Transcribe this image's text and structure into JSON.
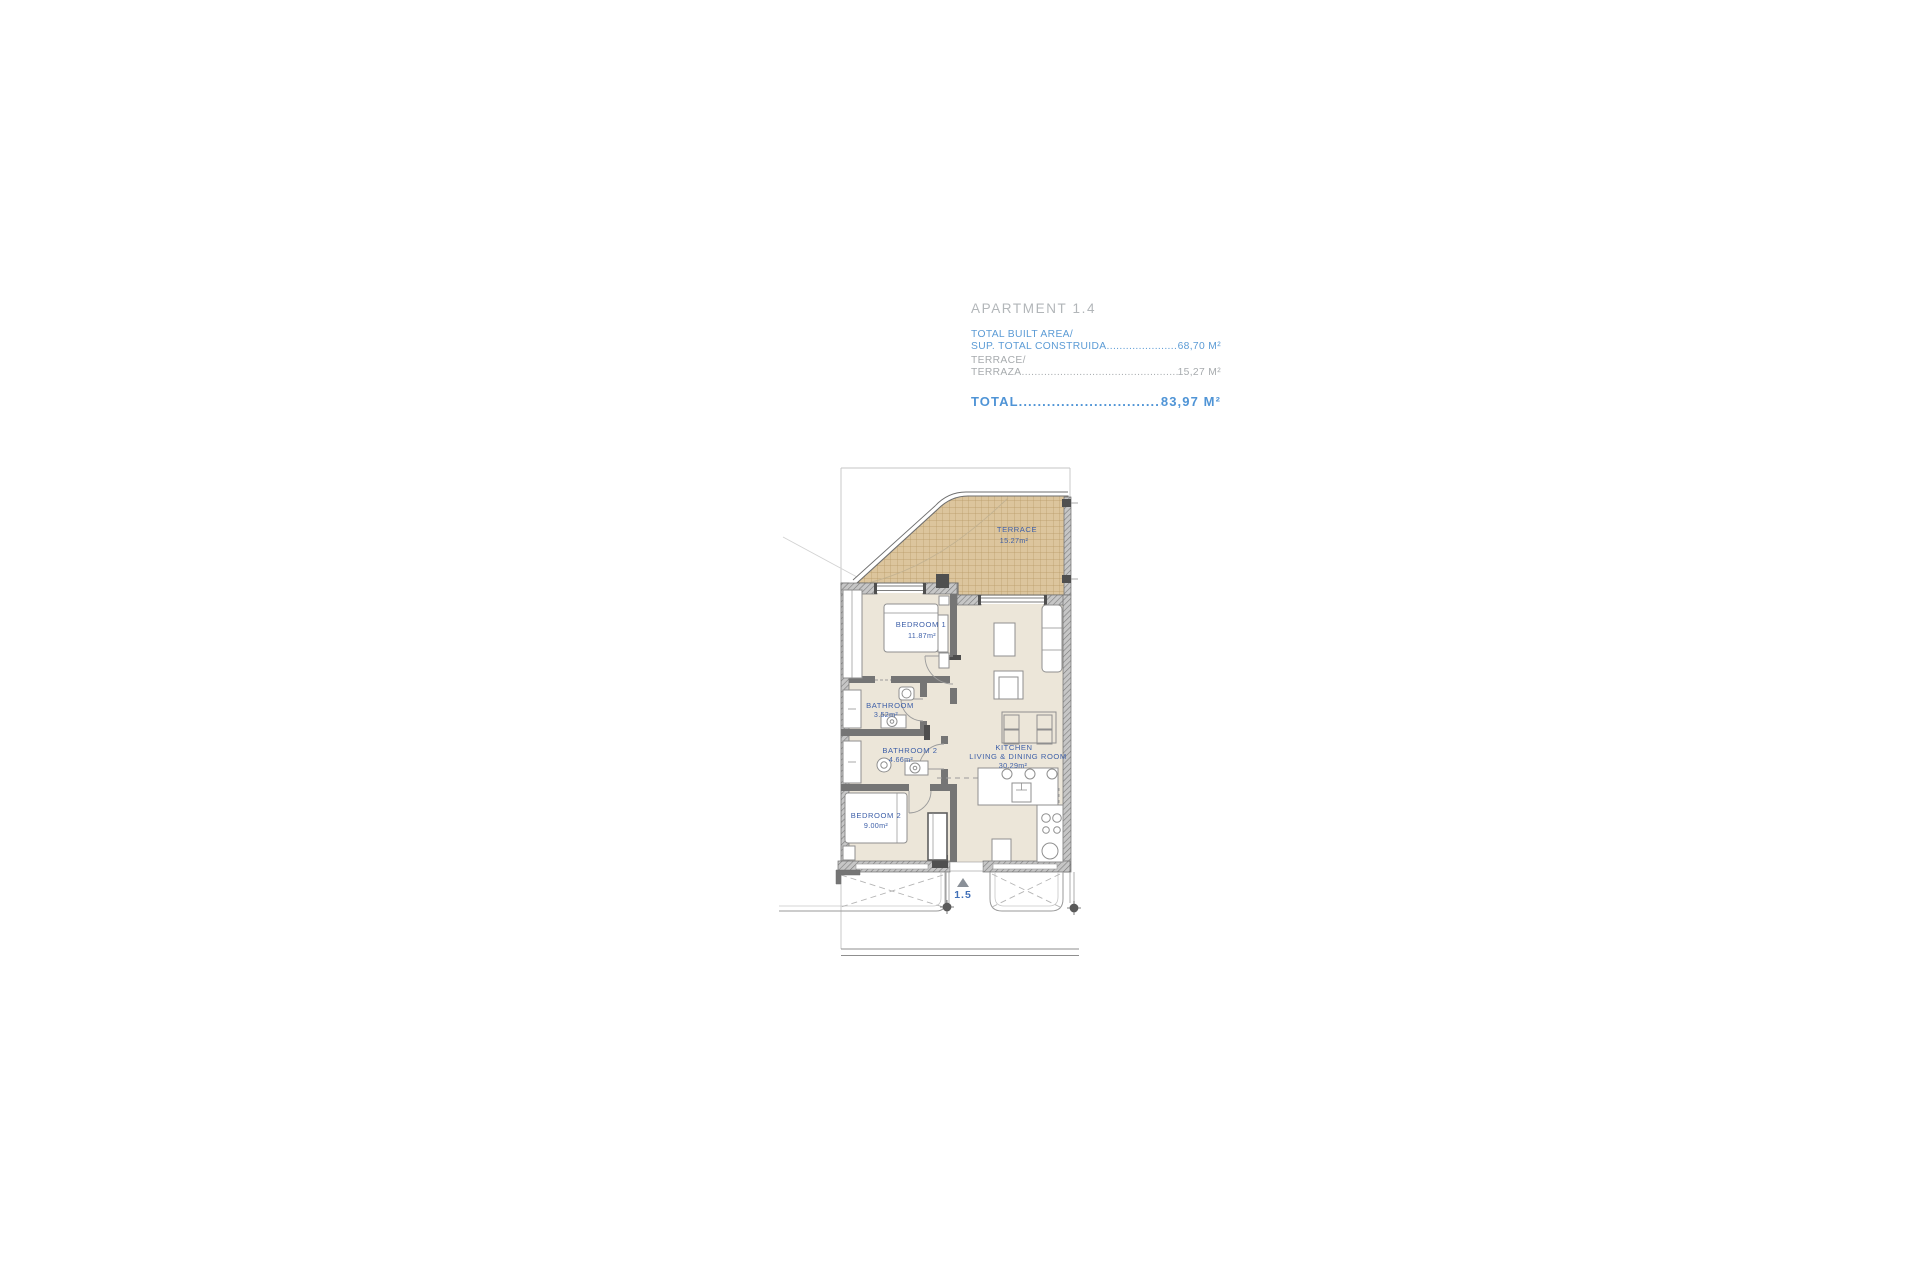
{
  "header": {
    "apartment_title": "APARTMENT 1.4",
    "built_area_line1": "TOTAL BUILT AREA/",
    "built_area_line2": "SUP. TOTAL CONSTRUIDA",
    "built_area_value": "68,70 M²",
    "terrace_line1": "TERRACE/",
    "terrace_line2": "TERRAZA",
    "terrace_value": "15,27 M²",
    "total_label": "TOTAL ",
    "total_value": "83,97 M²",
    "dots": "............................................................................................"
  },
  "floorplan": {
    "rooms": {
      "terrace": {
        "name": "TERRACE",
        "area": "15.27m²"
      },
      "bedroom1": {
        "name": "BEDROOM  1",
        "area": "11.87m²"
      },
      "bathroom1": {
        "name": "BATHROOM",
        "area": "3.52m²"
      },
      "bathroom2": {
        "name": "BATHROOM  2",
        "area": "4.66m²"
      },
      "bedroom2": {
        "name": "BEDROOM  2",
        "area": "9.00m²"
      },
      "kitchen": {
        "line1": "KITCHEN",
        "line2": "LIVING  &  DINING  ROOM",
        "area": "30.29m²"
      }
    },
    "level_marker": "1.5"
  },
  "colors": {
    "accent_blue": "#5b9bd5",
    "label_blue": "#3d5fa8",
    "muted_gray": "#a7abae",
    "floor_beige": "#ece6d9",
    "terrace_tan": "#dcc59d",
    "wall_gray": "#757575"
  }
}
